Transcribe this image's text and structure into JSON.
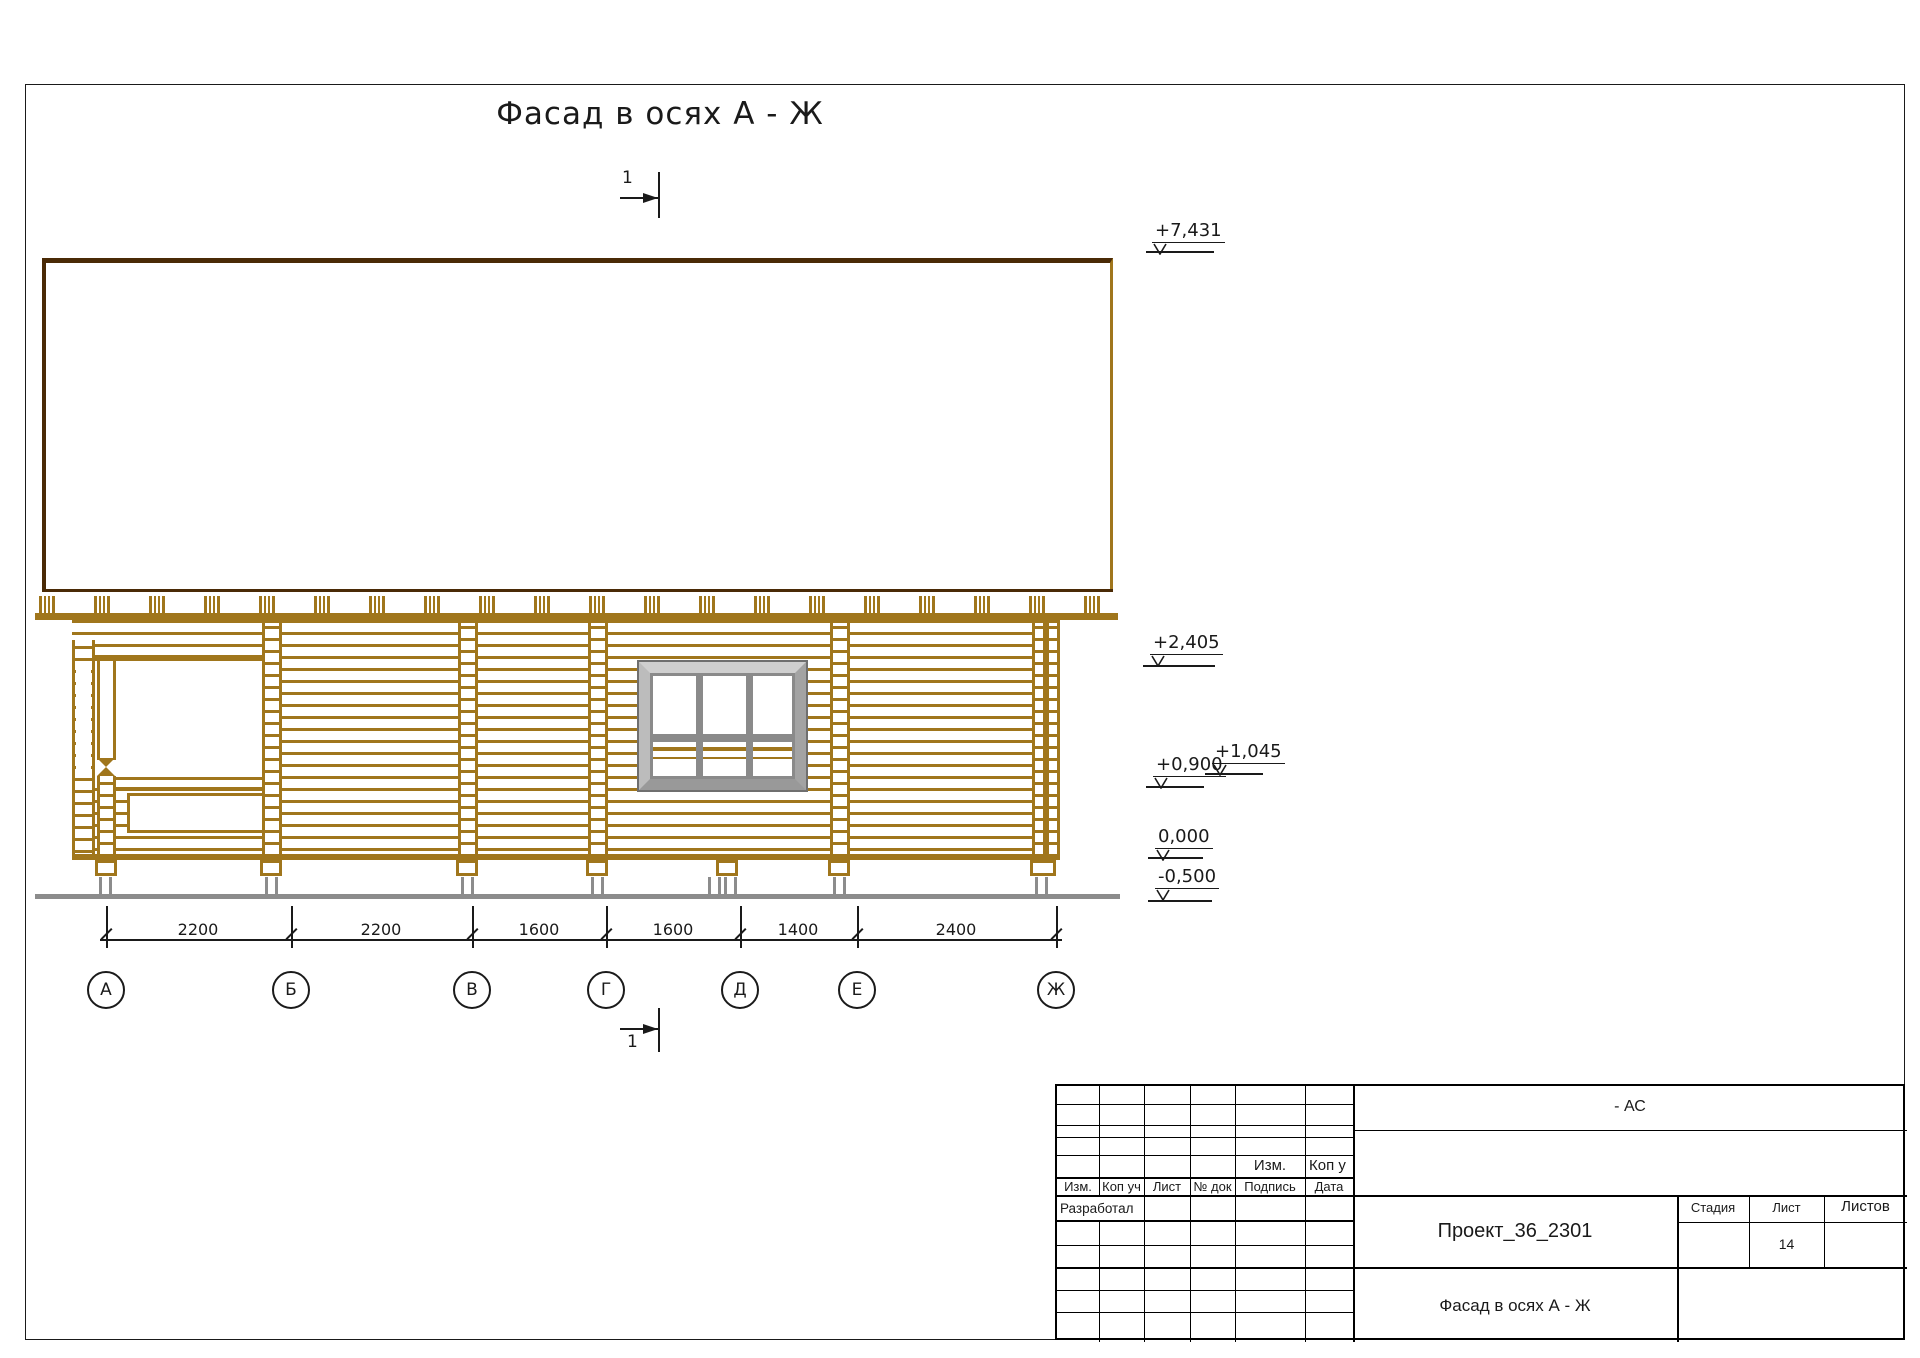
{
  "sheet": {
    "drawing_title": "Фасад в осях А - Ж",
    "section_mark_label": "1"
  },
  "elevations": [
    "+7,431",
    "+2,405",
    "+1,045",
    "+0,900",
    "0,000",
    "-0,500"
  ],
  "dimensions_mm": [
    "2200",
    "2200",
    "1600",
    "1600",
    "1400",
    "2400"
  ],
  "axes": [
    "А",
    "Б",
    "В",
    "Г",
    "Д",
    "Е",
    "Ж"
  ],
  "title_block": {
    "doc_code": "- АС",
    "project_name": "Проект_36_2301",
    "drawing_name": "Фасад в осях А - Ж",
    "upper_izm": "Изм.",
    "upper_kop": "Коп у",
    "header_row": [
      "Изм.",
      "Коп уч",
      "Лист",
      "№ док",
      "Подпись",
      "Дата"
    ],
    "role_label": "Разработал",
    "stage_label": "Стадия",
    "sheet_label": "Лист",
    "sheets_label": "Листов",
    "sheet_number": "14"
  },
  "colors": {
    "log_wood": "#a0761c",
    "dark_wood": "#4a2a06",
    "gray_elements": "#8c8c8c",
    "line": "#1a1a1a"
  }
}
